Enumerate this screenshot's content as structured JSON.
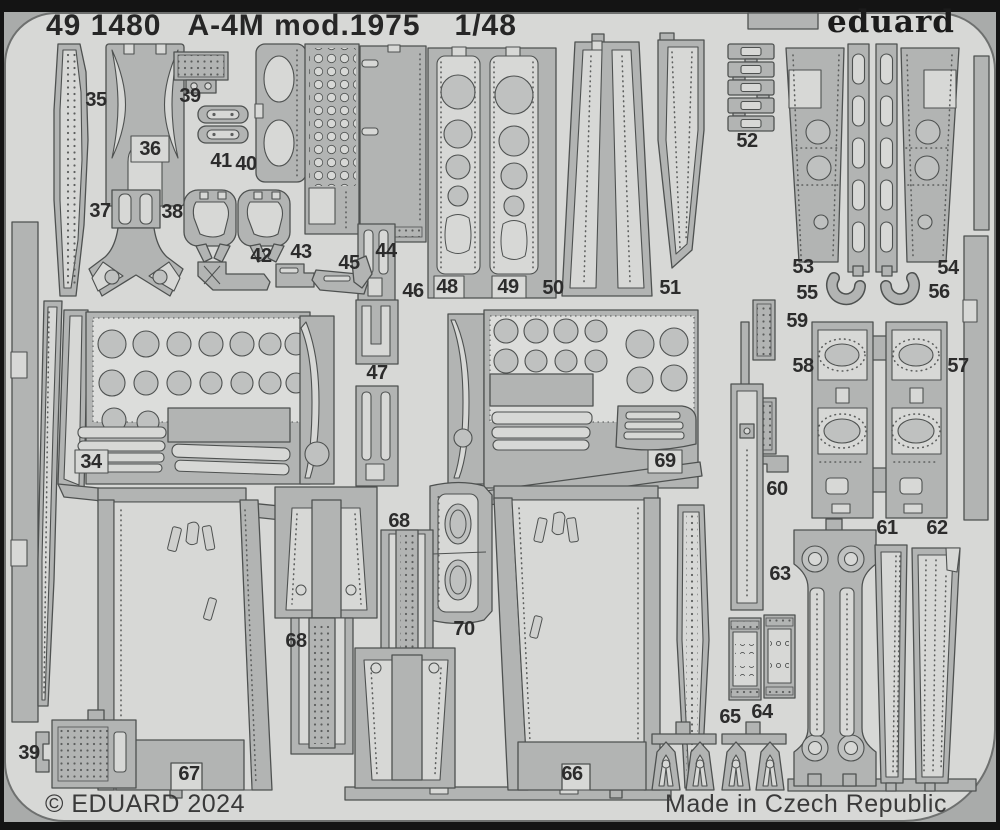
{
  "header": {
    "catalog_number": "49 1480",
    "title": "A-4M mod.1975",
    "scale": "1/48",
    "brand": "eduard"
  },
  "footer": {
    "copyright": "© EDUARD 2024",
    "origin": "Made in Czech Republic"
  },
  "colors": {
    "frame": "#141414",
    "backing": "#a9abaa",
    "sheet": "#d7d8d6",
    "metal": "#b2b4b3",
    "light": "#d7d8d6",
    "lightfield": "#dcdddb",
    "disc": "#bfc1c0",
    "bits": "#cfd0ce",
    "line": "#4e5150",
    "rivet": "#5c5e5d",
    "text": "#262626",
    "subtext": "#3a3a3a",
    "label": "#2c2c2c"
  },
  "parts": [
    {
      "label": "35",
      "x": 96,
      "y": 100
    },
    {
      "label": "36",
      "x": 150,
      "y": 149
    },
    {
      "label": "39",
      "x": 190,
      "y": 96
    },
    {
      "label": "41",
      "x": 221,
      "y": 161
    },
    {
      "label": "40",
      "x": 246,
      "y": 164
    },
    {
      "label": "37",
      "x": 100,
      "y": 211
    },
    {
      "label": "38",
      "x": 172,
      "y": 212
    },
    {
      "label": "42",
      "x": 261,
      "y": 256
    },
    {
      "label": "43",
      "x": 301,
      "y": 252
    },
    {
      "label": "45",
      "x": 349,
      "y": 263
    },
    {
      "label": "44",
      "x": 386,
      "y": 251
    },
    {
      "label": "46",
      "x": 413,
      "y": 291
    },
    {
      "label": "48",
      "x": 447,
      "y": 287
    },
    {
      "label": "49",
      "x": 508,
      "y": 287
    },
    {
      "label": "50",
      "x": 553,
      "y": 288
    },
    {
      "label": "51",
      "x": 670,
      "y": 288
    },
    {
      "label": "52",
      "x": 747,
      "y": 141
    },
    {
      "label": "53",
      "x": 803,
      "y": 267
    },
    {
      "label": "54",
      "x": 948,
      "y": 268
    },
    {
      "label": "55",
      "x": 807,
      "y": 293
    },
    {
      "label": "56",
      "x": 939,
      "y": 292
    },
    {
      "label": "59",
      "x": 797,
      "y": 321
    },
    {
      "label": "58",
      "x": 803,
      "y": 366
    },
    {
      "label": "57",
      "x": 958,
      "y": 366
    },
    {
      "label": "47",
      "x": 377,
      "y": 373
    },
    {
      "label": "34",
      "x": 91,
      "y": 462
    },
    {
      "label": "69",
      "x": 665,
      "y": 461
    },
    {
      "label": "60",
      "x": 777,
      "y": 489
    },
    {
      "label": "68",
      "x": 399,
      "y": 521
    },
    {
      "label": "61",
      "x": 887,
      "y": 528
    },
    {
      "label": "62",
      "x": 937,
      "y": 528
    },
    {
      "label": "63",
      "x": 780,
      "y": 574
    },
    {
      "label": "70",
      "x": 464,
      "y": 629
    },
    {
      "label": "68",
      "x": 296,
      "y": 641
    },
    {
      "label": "64",
      "x": 762,
      "y": 712
    },
    {
      "label": "65",
      "x": 730,
      "y": 717
    },
    {
      "label": "39",
      "x": 29,
      "y": 753
    },
    {
      "label": "67",
      "x": 189,
      "y": 774
    },
    {
      "label": "66",
      "x": 572,
      "y": 774
    }
  ]
}
